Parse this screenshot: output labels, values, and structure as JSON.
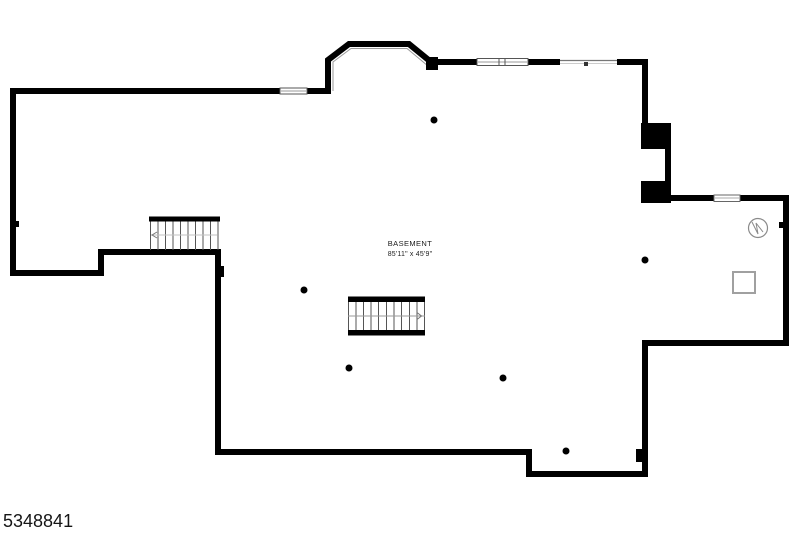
{
  "floor_plan": {
    "room": {
      "label": "BASEMENT",
      "dimensions": "85'11\" x 45'9\""
    },
    "listing_id": "5348841",
    "colors": {
      "wall": "#000000",
      "background": "#ffffff",
      "window_stroke": "#555555",
      "window_midline": "#9a9a9a",
      "stair_tread": "#555555",
      "symbol_stroke": "#8a8a8a"
    },
    "symbols": [
      {
        "name": "water-heater-symbol",
        "glyph": "circle-with-zigzag"
      },
      {
        "name": "furnace-symbol",
        "glyph": "square-outline"
      },
      {
        "name": "support-column",
        "glyph": "filled-dot",
        "count": 6
      },
      {
        "name": "staircase",
        "glyph": "hatched-treads",
        "count": 2
      }
    ]
  }
}
